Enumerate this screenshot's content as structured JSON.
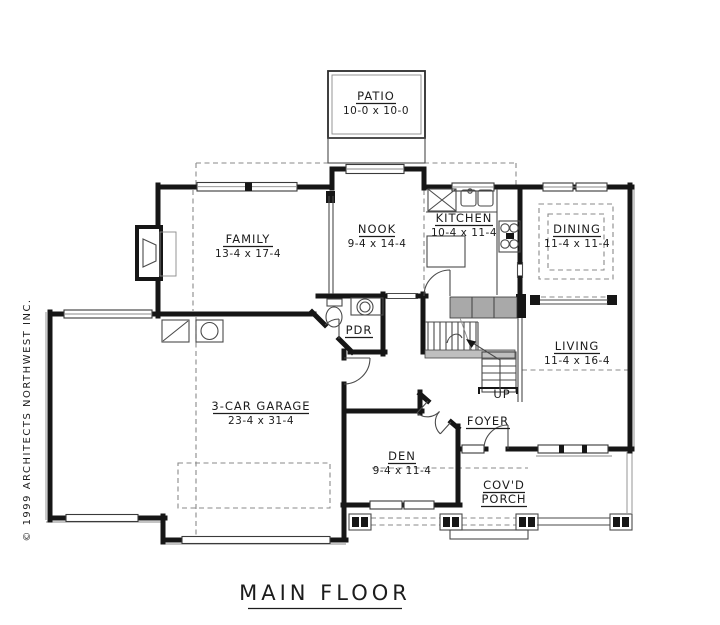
{
  "drawing": {
    "title": "MAIN FLOOR",
    "copyright": "© 1999 ARCHITECTS NORTHWEST INC."
  },
  "rooms": {
    "patio": {
      "name": "PATIO",
      "dims": "10-0 x 10-0"
    },
    "family": {
      "name": "FAMILY",
      "dims": "13-4 x 17-4"
    },
    "nook": {
      "name": "NOOK",
      "dims": "9-4 x 14-4"
    },
    "kitchen": {
      "name": "KITCHEN",
      "dims": "10-4 x 11-4"
    },
    "dining": {
      "name": "DINING",
      "dims": "11-4 x 11-4"
    },
    "living": {
      "name": "LIVING",
      "dims": "11-4 x 16-4"
    },
    "pdr": {
      "name": "PDR"
    },
    "garage": {
      "name": "3-CAR GARAGE",
      "dims": "23-4 x 31-4"
    },
    "den": {
      "name": "DEN",
      "dims": "9-4 x 11-4"
    },
    "foyer": {
      "name": "FOYER"
    },
    "porch": {
      "name_line1": "COV'D",
      "name_line2": "PORCH"
    }
  },
  "annotations": {
    "stairs": "UP"
  },
  "colors": {
    "background": "#ffffff",
    "wall": "#161616",
    "thin_line": "#4a4a4a",
    "dashed_line": "#8a8a8a"
  }
}
